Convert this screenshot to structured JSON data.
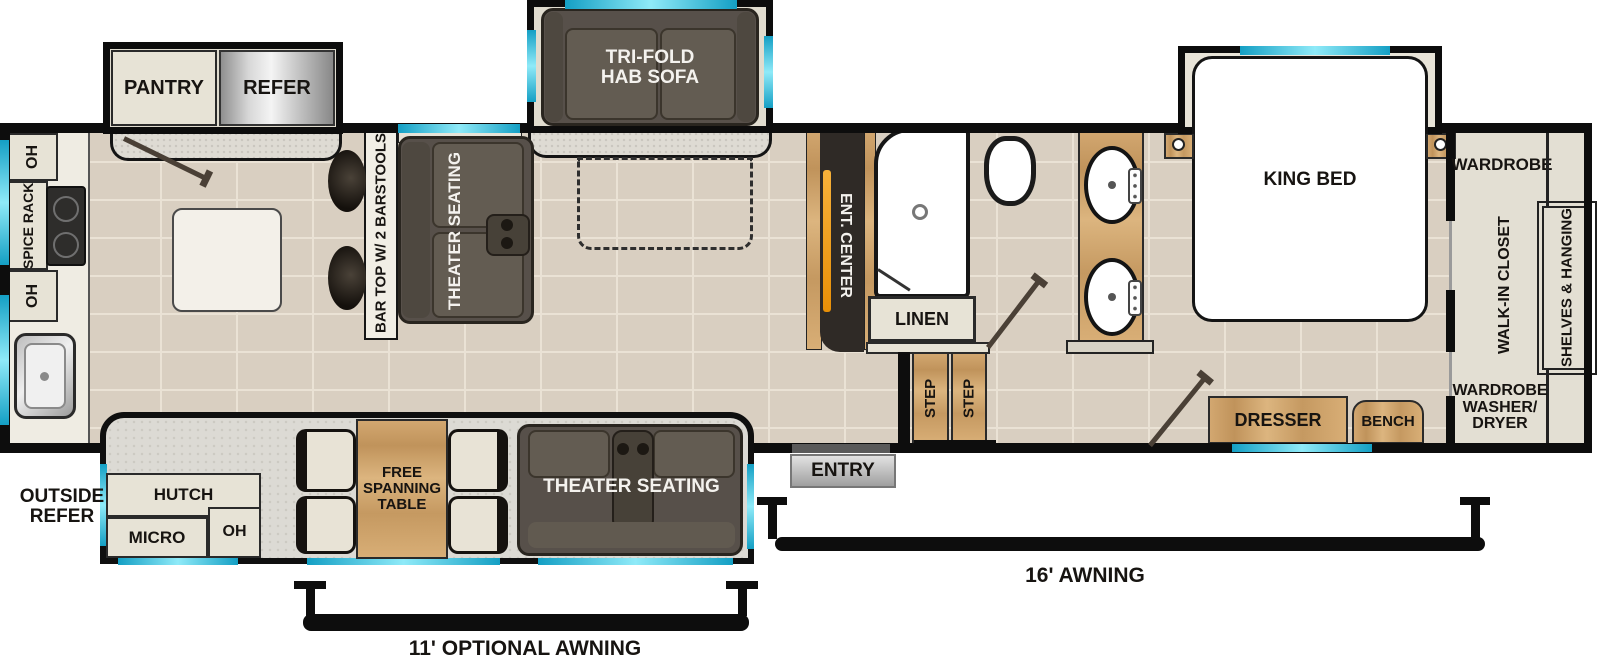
{
  "labels": {
    "pantry": "PANTRY",
    "refer": "REFER",
    "trifold": "TRI-FOLD\nHAB SOFA",
    "oh_a": "OH",
    "spice_rack": "SPICE RACK",
    "oh_b": "OH",
    "bar_top": "BAR TOP W/ 2 BARSTOOLS",
    "theater_upper": "THEATER SEATING",
    "ent_center": "ENT. CENTER",
    "linen": "LINEN",
    "step_a": "STEP",
    "step_b": "STEP",
    "king_bed": "KING BED",
    "wardrobe": "WARDROBE",
    "walk_in": "WALK-IN CLOSET",
    "shelves": "SHELVES & HANGING",
    "washer": "WARDROBE\nWASHER/\nDRYER",
    "dresser": "DRESSER",
    "bench": "BENCH",
    "outside_refer": "OUTSIDE\nREFER",
    "hutch": "HUTCH",
    "micro": "MICRO",
    "oh_c": "OH",
    "table": "FREE\nSPANNING\nTABLE",
    "theater_lower": "THEATER SEATING",
    "entry": "ENTRY",
    "awning_16": "16' AWNING",
    "awning_11": "11' OPTIONAL AWNING"
  },
  "colors": {
    "wall": "#0d0d0d",
    "window_teal": "#2fc0dd",
    "floor_tile": "#d9cfc1",
    "carpet": "#dcdad4",
    "wood": "#cda164",
    "sofa_dark": "#57504a",
    "fireplace_orange": "#ef9c14"
  }
}
